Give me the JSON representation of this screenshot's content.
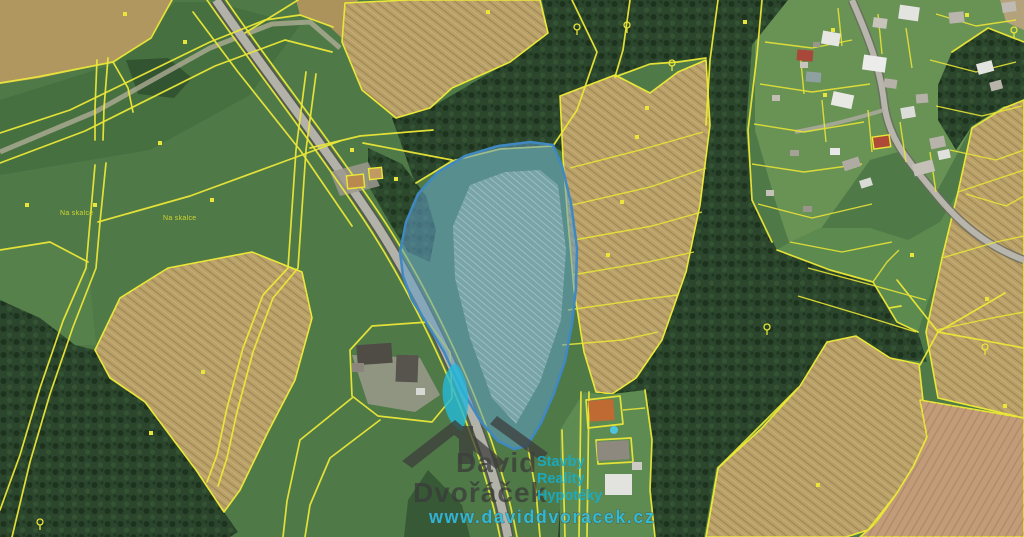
{
  "title": "Aerial cadastral map with highlighted parcel for sale",
  "place_labels": {
    "left": "Na skalce",
    "right": "Na skalce"
  },
  "watermark": {
    "first_name": "David",
    "last_name": "Dvořáček",
    "services": [
      "Stavby",
      "Reality",
      "Hypotéky"
    ],
    "website": "www.daviddvoracek.cz"
  },
  "highlighted_parcel": {
    "fill": "#639fc9",
    "stroke": "#3f88c2",
    "opacity": 0.55,
    "description": "blue highlighted parcel in map center"
  },
  "colors": {
    "parcel_line": "#ebe738",
    "field_green": "#4f7a48",
    "field_tan": "#b9a067",
    "forest": "#2b462c",
    "road": "#b2b2a8",
    "watermark_text": "#3b3b3b",
    "watermark_accent": "#15aecd",
    "website_color": "#2cc2e4",
    "marker_color": "#e9e53a",
    "pool_color": "#4ec3dc"
  }
}
